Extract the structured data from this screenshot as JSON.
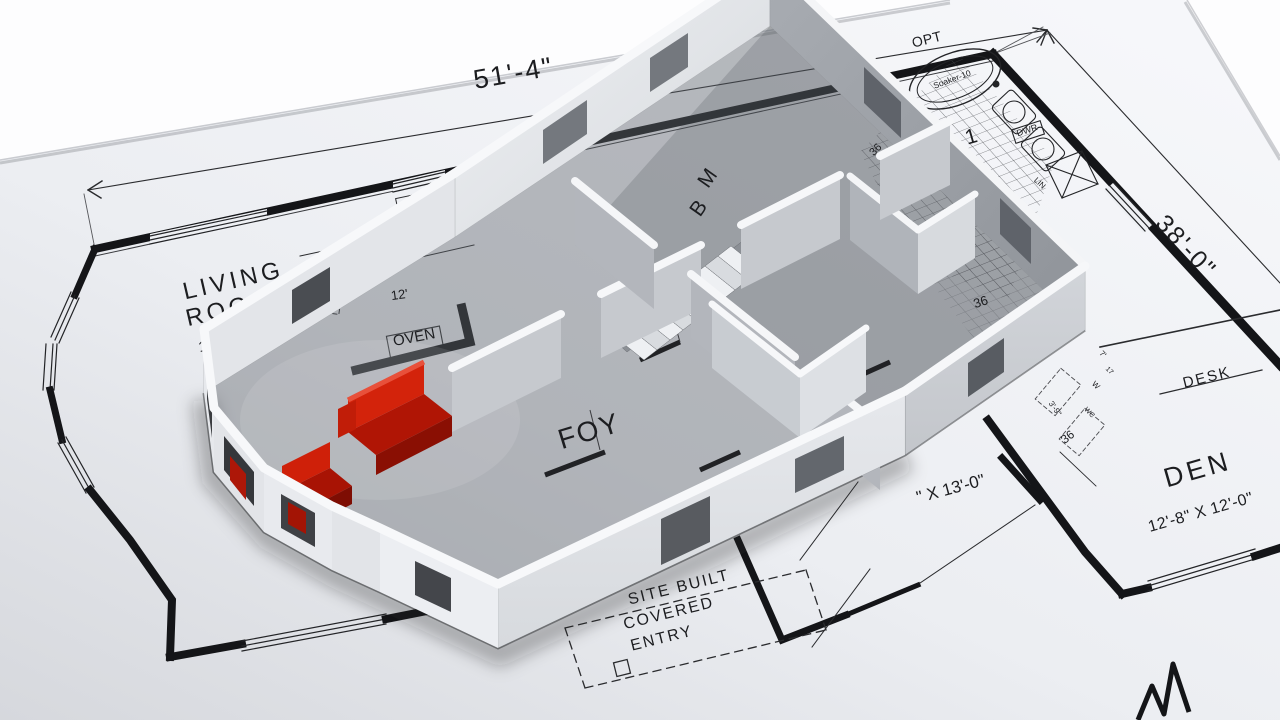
{
  "scene": {
    "type": "3d-floorplan-render",
    "paper_color": "#eef0f4",
    "accent_red": "#c41a0a",
    "line_color": "#1c1d20"
  },
  "dimensions": {
    "width_label": "51'-4\"",
    "height_label": "38'-0\""
  },
  "rooms": {
    "living": {
      "line1": "LIVING",
      "line2": "ROOM",
      "size": "13'-0\" X 13'-3\""
    },
    "den": {
      "name": "DEN",
      "size": "12'-8\" X 12'-0\""
    },
    "foyer": {
      "name": "FOY"
    },
    "master": {
      "initial1": "M",
      "initial2": "B"
    },
    "bath": {
      "partial_name": "A 1",
      "opt": "OPT"
    },
    "bedroom_size_partial": "\" X 13'-0\""
  },
  "fixtures": {
    "china": "CHINA",
    "dw": "DW",
    "oven": "OVEN",
    "desk": "DESK",
    "dwr": "DWR",
    "tub": "Soaker-10",
    "lin": "LIN",
    "w": "W",
    "wc": "WC"
  },
  "entry": {
    "line1": "SITE BUILT",
    "line2": "COVERED",
    "line3": "ENTRY"
  },
  "small_dims": {
    "win_a": "36",
    "win_b": "36",
    "win_floor": "36",
    "d12": "12'",
    "d7": "7'",
    "d17": "17",
    "d39": "3'-9\""
  }
}
